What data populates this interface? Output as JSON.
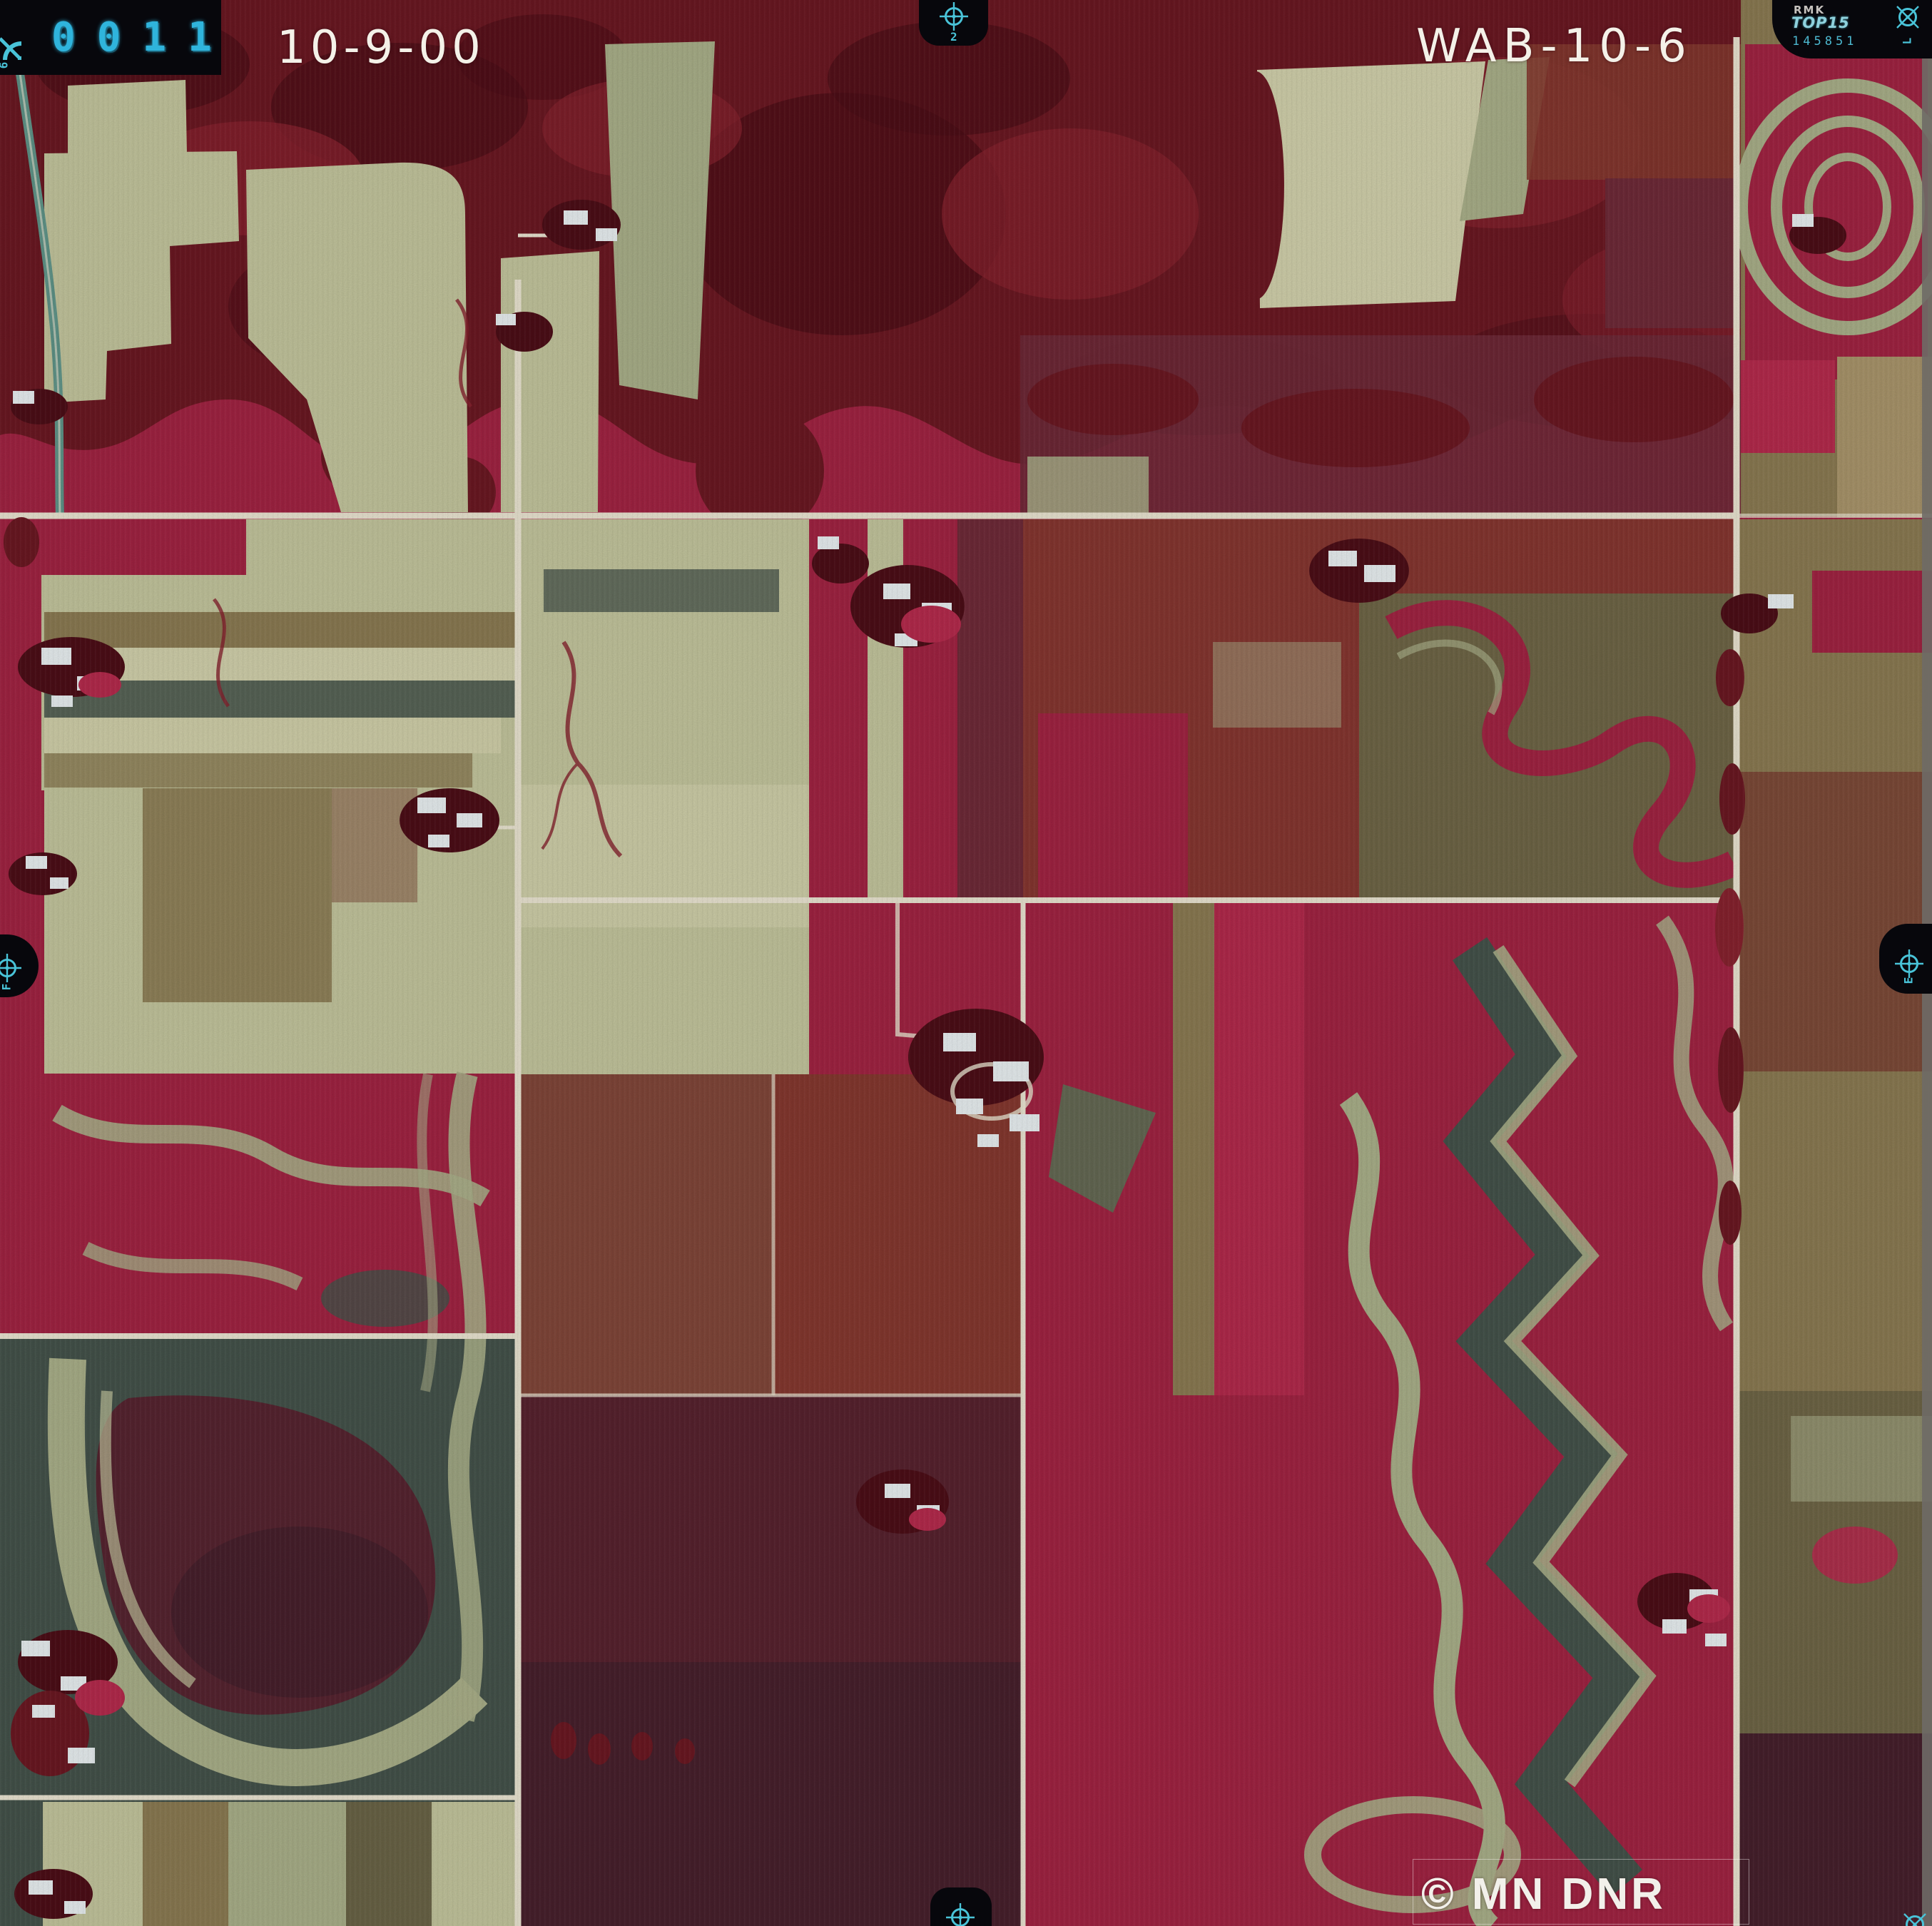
{
  "annotations": {
    "frame_counter": "0011",
    "date": "10-9-00",
    "photo_id": "WAB-10-6",
    "camera_tab": {
      "maker": "RMK",
      "model": "TOP15",
      "serial": "145851",
      "corner_letter": "L"
    },
    "copyright": "© MN DNR",
    "fiducial_labels": {
      "top_center": "2",
      "left_edge": "F",
      "right_edge": "E",
      "top_left_corner": "6"
    }
  },
  "palette": {
    "forest_dark": "#4c0e17",
    "forest": "#6a1822",
    "forest_red": "#86222e",
    "crimson": "#a02342",
    "crimson_bright": "#b42a4c",
    "maroon": "#6e2a38",
    "maroon_deep": "#57222e",
    "plum_dark": "#46202c",
    "sage": "#c2c49c",
    "sage_light": "#d0cfaa",
    "sage_dark": "#a8ae88",
    "olive": "#8a7a52",
    "olive_dark": "#6e6546",
    "olive_light": "#a8946a",
    "brown": "#7c4a38",
    "brown_red": "#84382f",
    "slate_green": "#44524a",
    "teal_field": "#5d7055",
    "road": "#e9e3d0",
    "building_white": "#e8eef0",
    "tab_black": "#07070c",
    "mark_cyan": "#49c3d8",
    "counter_cyan": "#2fb4dc",
    "text_white": "#f4f1e8",
    "edge_gray": "#6e6a66",
    "highway_teal": "#5f9488"
  }
}
